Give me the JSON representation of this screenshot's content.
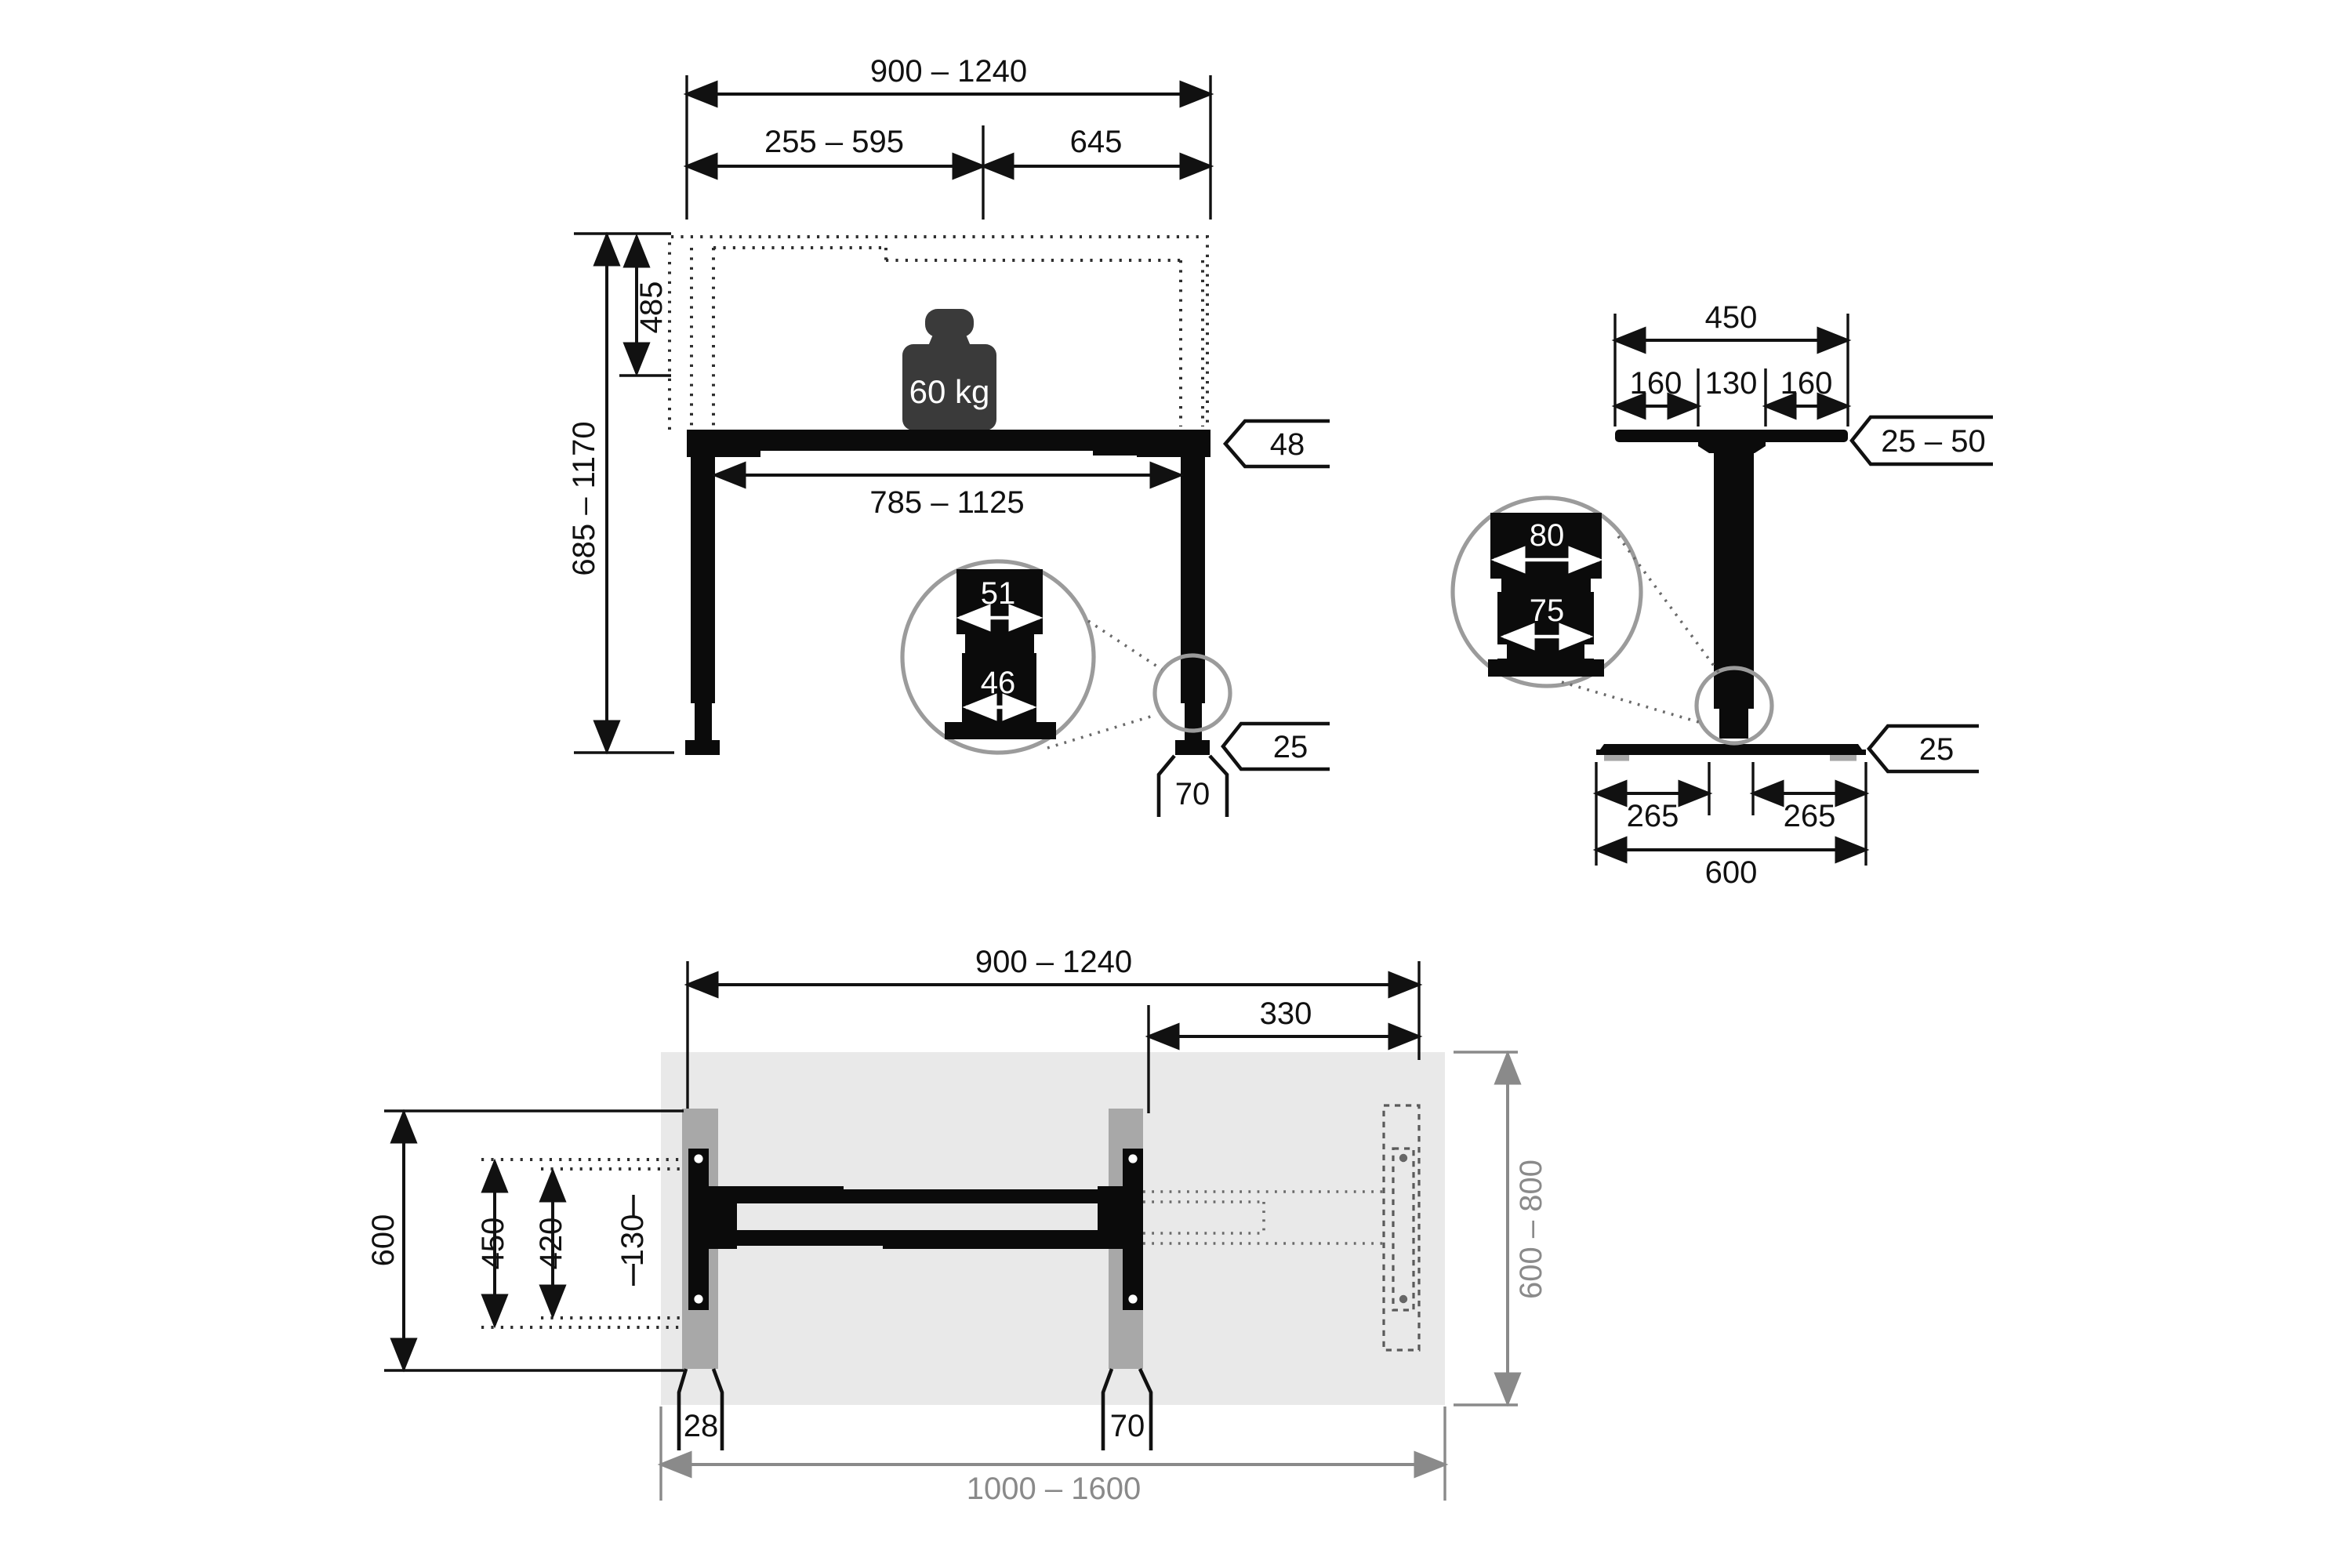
{
  "drawing_title": "height-adjustable desk frame dimension drawing",
  "colors": {
    "ink": "#111111",
    "weight_fill": "#3a3a3a",
    "tabletop_fill": "#e9e9e9",
    "foot_pad_fill": "#a8a8a8",
    "dim_gray": "#8a8a8a",
    "detail_circle_stroke": "#9b9b9b"
  },
  "front_view": {
    "total_width": "900 – 1240",
    "left_width": "255 – 595",
    "right_width": "645",
    "adjust_range": "485",
    "height_range": "685 – 1170",
    "inner_width": "785 – 1125",
    "frame_thickness": "48",
    "load_capacity": "60 kg",
    "leg_upper_width": "51",
    "leg_lower_width": "46",
    "foot_plate_height": "25",
    "foot_plate_width": "70"
  },
  "side_view": {
    "bracket_width": "450",
    "bracket_left": "160",
    "bracket_center": "130",
    "bracket_right": "160",
    "top_thickness_range": "25 – 50",
    "column_upper_width": "80",
    "column_lower_width": "75",
    "foot_height": "25",
    "foot_front": "265",
    "foot_rear": "265",
    "foot_length": "600"
  },
  "top_view": {
    "frame_width": "900 – 1240",
    "side_extension": "330",
    "foot_length": "600",
    "plate_length": "450",
    "hole_spacing": "420",
    "crossbar_width": "130",
    "left_foot_width": "28",
    "right_foot_width": "70",
    "tabletop_width_range": "1000 – 1600",
    "tabletop_depth_range": "600 – 800"
  }
}
